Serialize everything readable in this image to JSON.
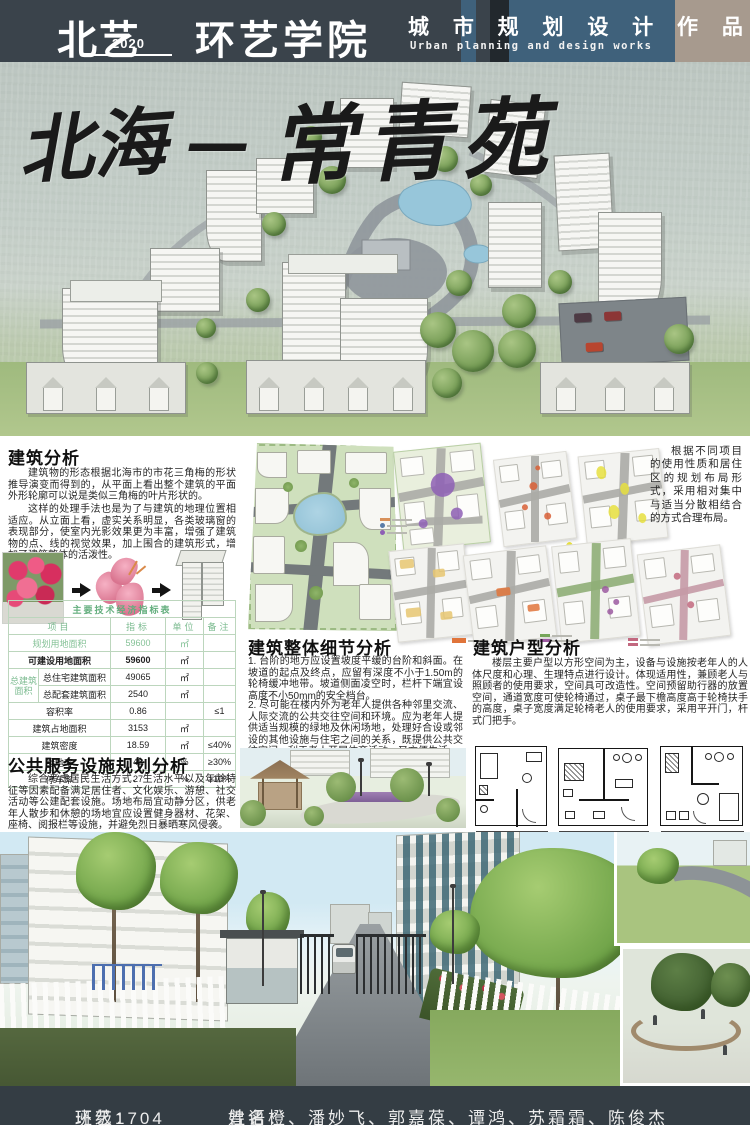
{
  "header": {
    "logo_text": "北艺",
    "logo_year": "2020",
    "department": "环艺学院",
    "title_cn": "城 市 规 划 设 计 作 品",
    "title_en": "Urban planning and design works"
  },
  "hero": {
    "title_left": "北海",
    "title_dash": "—",
    "title_right": "常青苑"
  },
  "building_analysis": {
    "heading": "建筑分析",
    "p1": "建筑物的形态根据北海市的市花三角梅的形状推导演变而得到的，从平面上看出整个建筑的平面外形轮廓可以说是类似三角梅的叶片形状的。",
    "p2": "这样的处理手法也是为了与建筑的地理位置相适应。从立面上看，虚实关系明显，各类玻璃窗的表现部分，使室内光影效果更为丰富，增强了建筑物的点、线的视觉效果，加上围合的建筑形式，增加了建筑整体的活泼性。"
  },
  "indicator_table": {
    "title": "主要技术经济指标表",
    "columns": [
      "项目",
      "指标",
      "单位",
      "备注"
    ],
    "group_label": "总建筑面积",
    "rows": [
      {
        "item": "规划用地面积",
        "value": "59600",
        "unit": "㎡",
        "note": ""
      },
      {
        "item": "可建设用地面积",
        "value": "59600",
        "unit": "㎡",
        "note": ""
      },
      {
        "item": "总住宅建筑面积",
        "value": "49065",
        "unit": "㎡",
        "note": ""
      },
      {
        "item": "总配套建筑面积",
        "value": "2540",
        "unit": "㎡",
        "note": ""
      },
      {
        "item": "容积率",
        "value": "0.86",
        "unit": "",
        "note": "≤1"
      },
      {
        "item": "建筑占地面积",
        "value": "3153",
        "unit": "㎡",
        "note": ""
      },
      {
        "item": "建筑密度",
        "value": "18.59",
        "unit": "㎡",
        "note": "≤40%"
      },
      {
        "item": "绿地率",
        "value": "48",
        "unit": "%",
        "note": "≥30%"
      },
      {
        "item": "停车率",
        "value": "27",
        "unit": "%",
        "note": "≥10%"
      }
    ]
  },
  "public_service": {
    "heading": "公共服务设施规划分析",
    "p1": "综合考虑居民生活方式、生活水平以及年龄特征等因素配备满足居住者、文化娱乐、游憩、社交活动等公建配套设施。场地布局宜动静分区，供老年人散步和休憩的场地宜应设置健身器材、花架、座椅、阅报栏等设施，并避免烈日暴晒寒风侵袭。"
  },
  "overall_detail": {
    "heading": "建筑整体细节分析",
    "p1": "1. 台阶的地方应设置坡度平缓的台阶和斜面。在坡道的起点及终点，应留有深度不小于1.50m的轮椅缓冲地带。坡道侧面凌空时，栏杆下端宜设高度不小50mm的安全档台。",
    "p2": "2. 尽可能在楼内外为老年人提供各种邻里交流、人际交流的公共交往空间和环境。应为老年人提供适当规模的绿地及休闲场地，处理好合设或邻设的其他设施与住宅之间的关系，既提供公共交往空间，利于老人开展体育活动，又方便生活。"
  },
  "layout_note": {
    "p1": "根据不同项目的使用性质和居住区的规划布局形式，采用相对集中与适当分散相结合的方式合理布局。"
  },
  "unit_analysis": {
    "heading": "建筑户型分析",
    "p1": "楼层主要户型以方形空间为主，设备与设施按老年人的人体尺度和心理、生理特点进行设计。体现适用性，兼顾老人与照顾者的使用要求，空间具可改造性。空间预留助行器的放置空间，通道宽度可使轮椅通过，桌子最下檐高度高于轮椅扶手的高度，桌子宽度满足轮椅老人的使用要求，采用平开门，杆式门把手。"
  },
  "diagrams": {
    "accents": [
      "#8e5fb5",
      "#d85f36",
      "#e6df3e",
      "#e6c670",
      "#e0743a",
      "#76a65a",
      "#c2687f"
    ],
    "secondary": "#9b59a0"
  },
  "footer": {
    "class_label": "班级：",
    "class_value": "环艺1704",
    "names_label": "姓名：",
    "names": "曾语橙、潘妙飞、郭嘉葆、谭鸿、苏霜霜、陈俊杰"
  },
  "colors": {
    "header_bg": "#3a434b",
    "panel_blue": "#3f617b",
    "stripe_dark": "#22282d",
    "block_tan": "#a79a8e",
    "table_green": "#63ae7d",
    "footer_bg": "#343d44"
  }
}
